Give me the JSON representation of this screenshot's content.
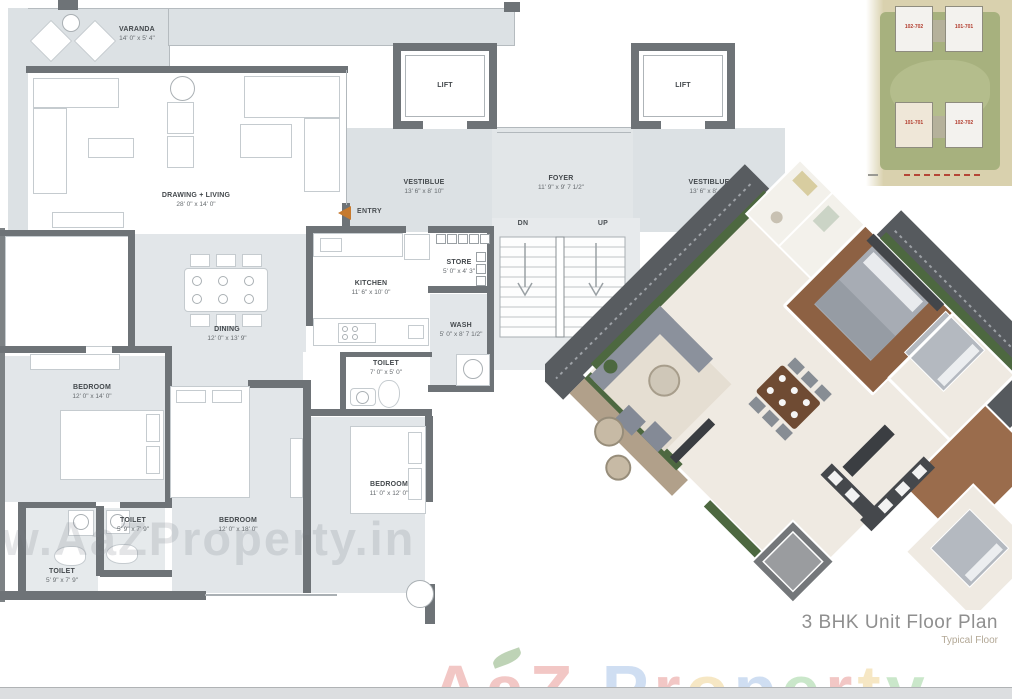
{
  "title": {
    "main": "3 BHK Unit Floor Plan",
    "sub": "Typical Floor"
  },
  "entry_label": "ENTRY",
  "stairs": {
    "down": "DN",
    "up": "UP"
  },
  "rooms": {
    "varanda": {
      "name": "VARANDA",
      "dim": "14' 0\" x 5' 4\""
    },
    "drawing_living": {
      "name": "DRAWING + LIVING",
      "dim": "28' 0\" x 14' 0\""
    },
    "lift1": {
      "name": "LIFT"
    },
    "lift2": {
      "name": "LIFT"
    },
    "vestibule1": {
      "name": "VESTIBLUE",
      "dim": "13' 6\" x 8' 10\""
    },
    "foyer": {
      "name": "FOYER",
      "dim": "11' 9\" x 9' 7 1/2\""
    },
    "vestibule2": {
      "name": "VESTIBLUE",
      "dim": "13' 6\" x 8' 10\""
    },
    "kitchen": {
      "name": "KITCHEN",
      "dim": "11' 6\" x 10' 0\""
    },
    "store": {
      "name": "STORE",
      "dim": "5' 0\" x 4' 3\""
    },
    "wash": {
      "name": "WASH",
      "dim": "5' 0\" x 8' 7 1/2\""
    },
    "toilet_kitchen": {
      "name": "TOILET",
      "dim": "7' 0\" x 5' 0\""
    },
    "dining": {
      "name": "DINING",
      "dim": "12' 0\" x 13' 9\""
    },
    "bedroom1": {
      "name": "BEDROOM",
      "dim": "12' 0\" x 14' 0\""
    },
    "toilet_a": {
      "name": "TOILET",
      "dim": "5' 9\" x 7' 9\""
    },
    "toilet_b": {
      "name": "TOILET",
      "dim": "5' 9\" x 7' 9\""
    },
    "bedroom2": {
      "name": "BEDROOM",
      "dim": "12' 0\" x 18' 0\""
    },
    "bedroom3": {
      "name": "BEDROOM",
      "dim": "11' 0\" x 12' 0\""
    }
  },
  "siteplan": {
    "units": [
      "102-702",
      "101-701",
      "101-701",
      "102-702"
    ]
  },
  "watermark": {
    "url": "www.AaZProperty.in",
    "brand_letters": [
      {
        "ch": "A",
        "color": "#d9534f"
      },
      {
        "ch": "a",
        "color": "#d9534f"
      },
      {
        "ch": "Z",
        "color": "#d9534f"
      },
      {
        "ch": " ",
        "color": "#000000"
      },
      {
        "ch": "P",
        "color": "#6e9bd8"
      },
      {
        "ch": "r",
        "color": "#d9534f"
      },
      {
        "ch": "o",
        "color": "#e6b84c"
      },
      {
        "ch": "p",
        "color": "#6e9bd8"
      },
      {
        "ch": "e",
        "color": "#5cb85c"
      },
      {
        "ch": "r",
        "color": "#d9534f"
      },
      {
        "ch": "t",
        "color": "#e6b84c"
      },
      {
        "ch": "y",
        "color": "#5cb85c"
      }
    ]
  },
  "colors": {
    "wall": "#6e7377",
    "room_fill": "#e2e6e9",
    "vestibule_fill": "#dce1e4",
    "entry_arrow": "#c77a2e",
    "site_tan": "#d9d1ae",
    "site_green": "#a7b17e",
    "unit_red": "#b23c2d",
    "wood_floor": "#8d6143",
    "railing": "#565a5e",
    "hedge": "#4d6840",
    "title_gray": "#8f8f8f"
  }
}
